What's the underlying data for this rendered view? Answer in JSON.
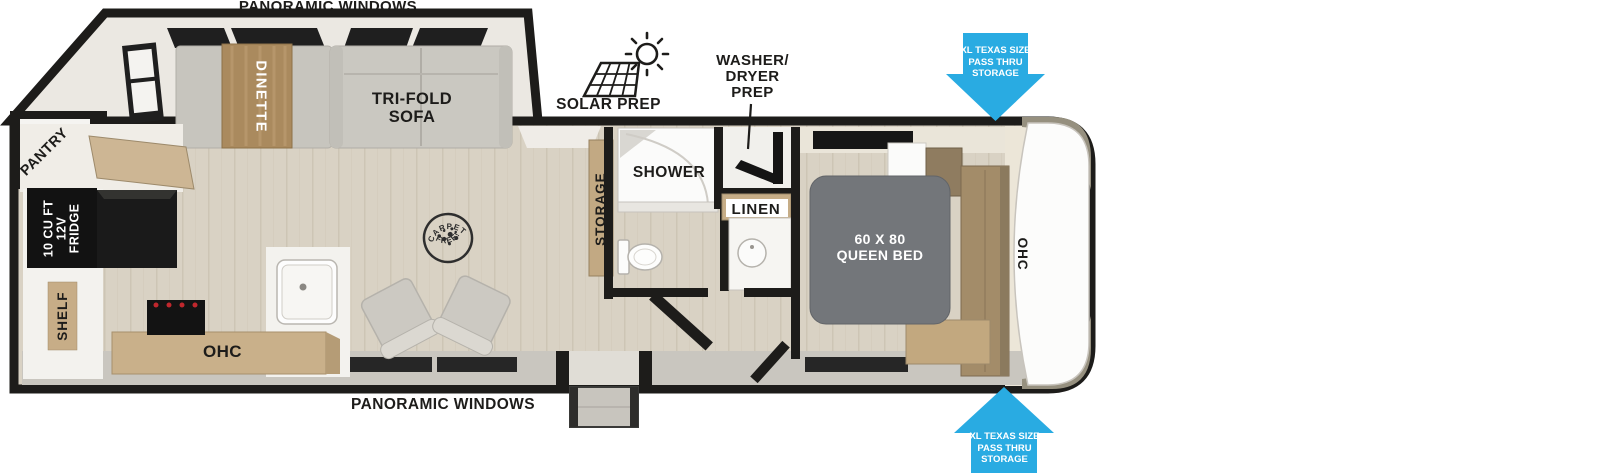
{
  "title": "Travel trailer floor plan",
  "colors": {
    "accent_blue": "#29abe2",
    "wall_black": "#1d1c1a",
    "floor_wood": "#d9d2c4",
    "cabinet_tan": "#c9b08a",
    "upholstery_gray": "#cac8c1",
    "bed_gray": "#73767a",
    "table_wood": "#aa8a5e"
  },
  "labels": {
    "panoramic_windows_top": "PANORAMIC WINDOWS",
    "panoramic_windows_bottom": "PANORAMIC WINDOWS",
    "solar_prep": "SOLAR PREP",
    "washer_dryer_prep": {
      "line1": "WASHER/",
      "line2": "DRYER",
      "line3": "PREP"
    },
    "dinette": "DINETTE",
    "tri_fold_sofa": {
      "line1": "TRI-FOLD",
      "line2": "SOFA"
    },
    "pantry": "PANTRY",
    "fridge": {
      "line1": "10 CU FT",
      "line2": "12V",
      "line3": "FRIDGE"
    },
    "shelf": "SHELF",
    "ohc_kitchen": "OHC",
    "carpet_free_stamp": {
      "top": "CARPET",
      "bottom": "FREE!"
    },
    "storage": "STORAGE",
    "shower": "SHOWER",
    "linen": "LINEN",
    "queen_bed": {
      "line1": "60 X 80",
      "line2": "QUEEN BED"
    },
    "ohc_bedroom": "OHC",
    "pass_thru_top": {
      "line1": "XL TEXAS SIZE",
      "line2": "PASS THRU",
      "line3": "STORAGE"
    },
    "pass_thru_bottom": {
      "line1": "XL TEXAS SIZE",
      "line2": "PASS THRU",
      "line3": "STORAGE"
    }
  }
}
